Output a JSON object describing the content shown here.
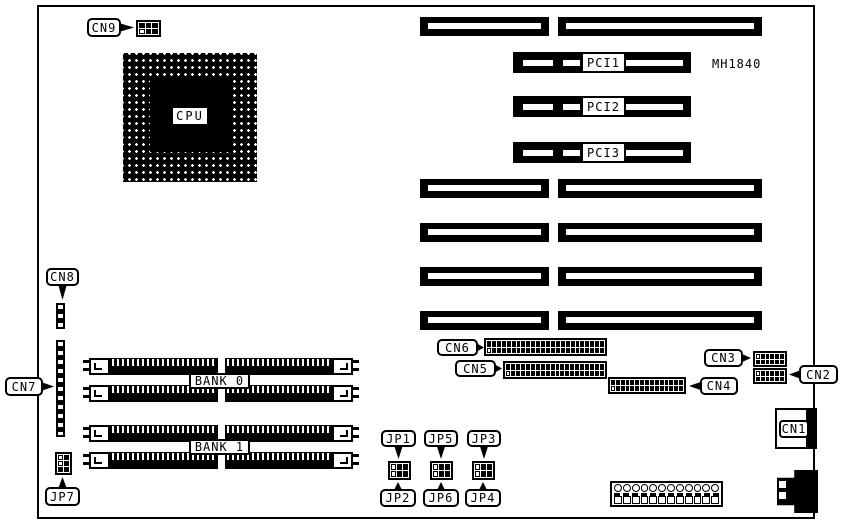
{
  "board": {
    "model": "MH1840"
  },
  "cpu": {
    "label": "CPU"
  },
  "pci_slots": [
    {
      "label": "PCI1"
    },
    {
      "label": "PCI2"
    },
    {
      "label": "PCI3"
    }
  ],
  "memory_banks": [
    {
      "label": "BANK 0"
    },
    {
      "label": "BANK 1"
    }
  ],
  "connectors": {
    "cn1": {
      "label": "CN1"
    },
    "cn2": {
      "label": "CN2"
    },
    "cn3": {
      "label": "CN3"
    },
    "cn4": {
      "label": "CN4"
    },
    "cn5": {
      "label": "CN5"
    },
    "cn6": {
      "label": "CN6"
    },
    "cn7": {
      "label": "CN7"
    },
    "cn8": {
      "label": "CN8"
    },
    "cn9": {
      "label": "CN9"
    }
  },
  "jumpers": {
    "jp1": {
      "label": "JP1"
    },
    "jp2": {
      "label": "JP2"
    },
    "jp3": {
      "label": "JP3"
    },
    "jp4": {
      "label": "JP4"
    },
    "jp5": {
      "label": "JP5"
    },
    "jp6": {
      "label": "JP6"
    },
    "jp7": {
      "label": "JP7"
    }
  },
  "colors": {
    "ink": "#000000",
    "paper": "#ffffff"
  }
}
